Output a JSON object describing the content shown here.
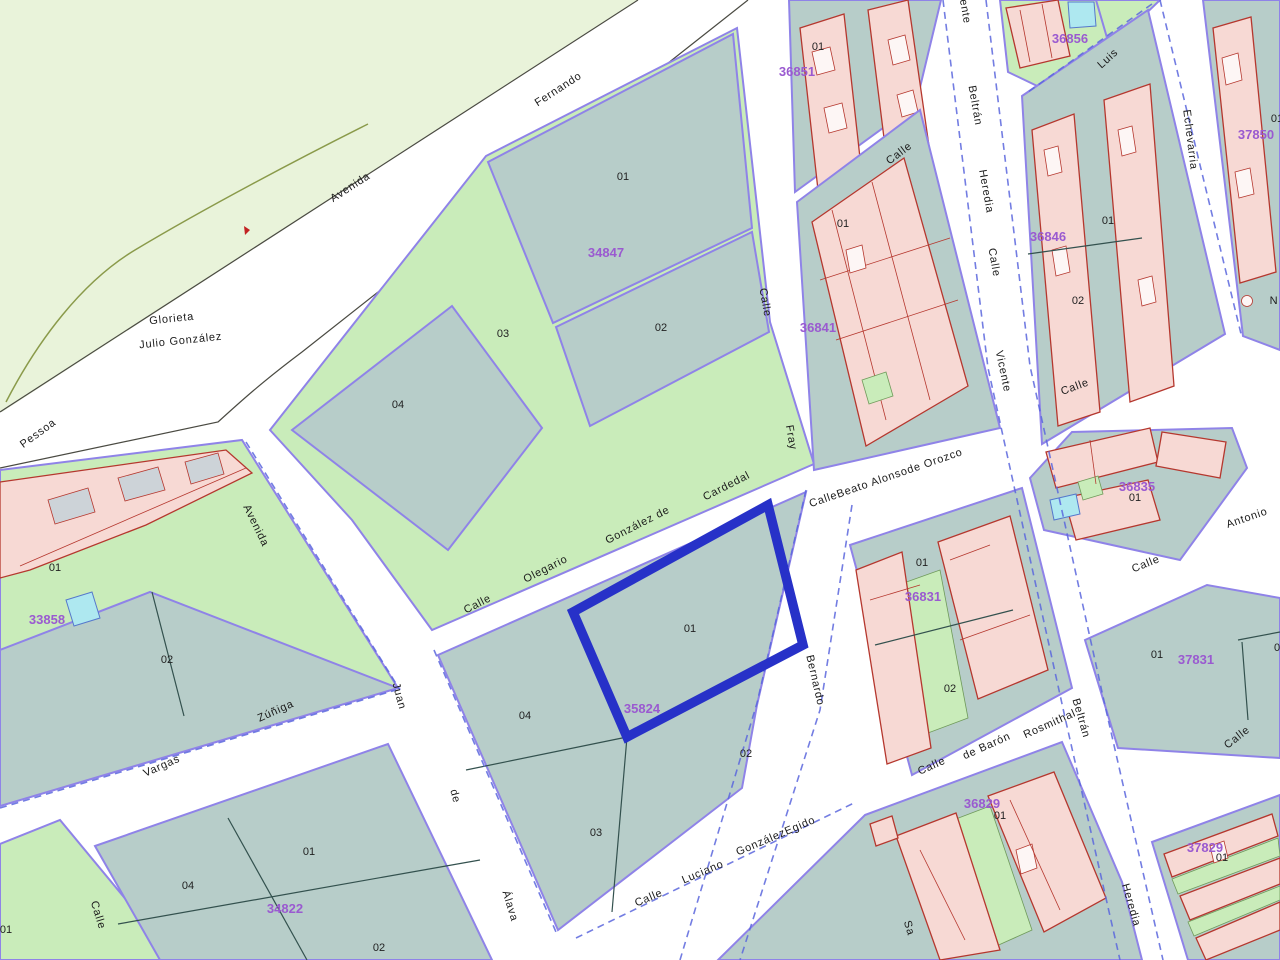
{
  "app": {
    "type": "cadastral-map-viewer"
  },
  "selected_parcel": {
    "parcel": "01",
    "block_code": "35824"
  },
  "colors": {
    "selection_blue": "#2731c8",
    "parcel_code_purple": "#9a5ad0",
    "parcel_teal": "#b7cdc9",
    "park_green": "#e9f3da",
    "strip_green": "#c9ecba",
    "building_pink": "#f7d9d4",
    "building_outline_red": "#b5372e",
    "block_outline_violet": "#8f83e8",
    "street_dash_blue": "#5a66dd",
    "water_cyan": "#aee8f0"
  },
  "blocks": [
    {
      "code": "34847",
      "parcels": [
        "01",
        "02",
        "03",
        "04"
      ]
    },
    {
      "code": "33858",
      "parcels": [
        "01",
        "02"
      ]
    },
    {
      "code": "34822",
      "parcels": [
        "04",
        "01",
        "02"
      ]
    },
    {
      "code": "35824",
      "parcels": [
        "01",
        "04",
        "02",
        "03"
      ]
    },
    {
      "code": "36851",
      "parcels": [
        "01"
      ]
    },
    {
      "code": "36856",
      "parcels": []
    },
    {
      "code": "36841",
      "parcels": [
        "01"
      ]
    },
    {
      "code": "36846",
      "parcels": [
        "01",
        "02"
      ]
    },
    {
      "code": "37850",
      "parcels": [
        "01"
      ]
    },
    {
      "code": "36831",
      "parcels": [
        "01",
        "02"
      ]
    },
    {
      "code": "36835",
      "parcels": [
        "01"
      ]
    },
    {
      "code": "37831",
      "parcels": [
        "01",
        "0"
      ]
    },
    {
      "code": "36829",
      "parcels": [
        "01"
      ]
    },
    {
      "code": "37829",
      "parcels": [
        "01"
      ]
    },
    {
      "parcels": [
        "01"
      ]
    }
  ],
  "streets": [
    {
      "name": "Avenida Fernando",
      "words": [
        "Fernando",
        "Avenida"
      ]
    },
    {
      "name": "Glorieta Julio González",
      "words": [
        "Glorieta",
        "Julio González"
      ]
    },
    {
      "name": "Pessoa",
      "words": [
        "Pessoa"
      ]
    },
    {
      "name": "Calle Olegario González de Cardedal",
      "words": [
        "Calle",
        "Olegario",
        "González de",
        "Cardedal"
      ]
    },
    {
      "name": "Calle Fray",
      "words": [
        "Calle",
        "Fray"
      ]
    },
    {
      "name": "Calle Vicente Beltrán Heredia",
      "words": [
        "ente",
        "Beltrán",
        "Heredia",
        "Calle",
        "Vicente",
        "Beltrán",
        "Heredia"
      ]
    },
    {
      "name": "Calle",
      "words": [
        "Calle"
      ]
    },
    {
      "name": "Luis",
      "words": [
        "Luis"
      ]
    },
    {
      "name": "Echevarria",
      "words": [
        "Echevarria"
      ]
    },
    {
      "name": "CalleBeato Alonsode Orozco",
      "words": [
        "CalleBeato Alonsode Orozco"
      ]
    },
    {
      "name": "Calle",
      "words": [
        "Calle"
      ]
    },
    {
      "name": "Bernardo",
      "words": [
        "Bernardo"
      ]
    },
    {
      "name": "Calle de Barón Rosmithal",
      "words": [
        "Calle",
        "de Barón",
        "Rosmithal"
      ]
    },
    {
      "name": "Calle Luciano GonzálezEgido",
      "words": [
        "Calle",
        "Luciano",
        "GonzálezEgido"
      ]
    },
    {
      "name": "Juan de Álava",
      "words": [
        "Juan",
        "de",
        "Álava"
      ]
    },
    {
      "name": "Vargas Zúñiga",
      "words": [
        "Zúñiga",
        "Vargas"
      ]
    },
    {
      "name": "Avenida",
      "words": [
        "Avenida"
      ]
    },
    {
      "name": "Calle",
      "words": [
        "Calle"
      ]
    },
    {
      "name": "Antonio",
      "words": [
        "Antonio"
      ]
    },
    {
      "name": "Calle",
      "words": [
        "Calle"
      ]
    },
    {
      "name": "Calle",
      "words": [
        "Calle"
      ]
    },
    {
      "name": "N",
      "words": [
        "N"
      ]
    },
    {
      "name": "Sa",
      "words": [
        "Sa"
      ]
    }
  ]
}
